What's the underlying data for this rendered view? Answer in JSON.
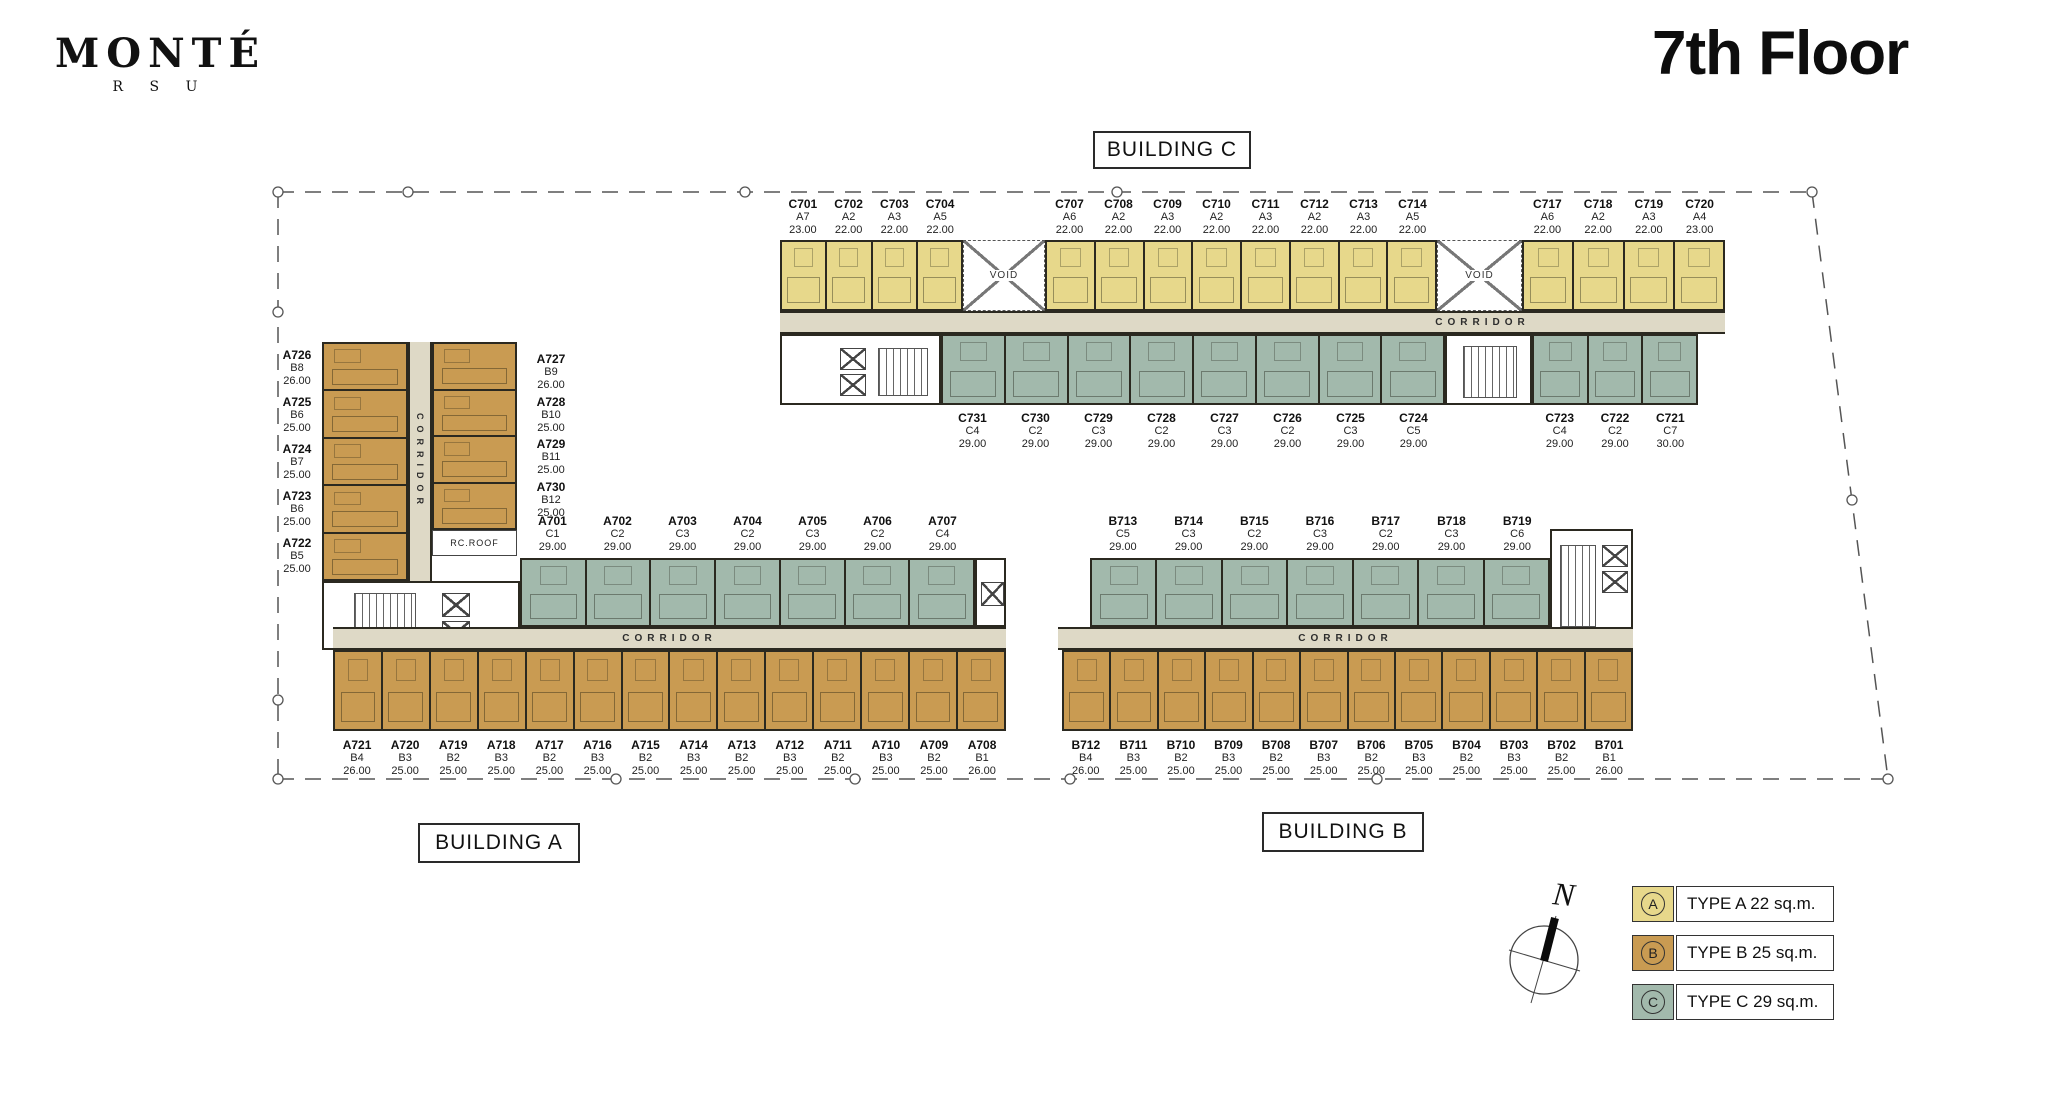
{
  "header": {
    "logo_title": "MONTÉ",
    "logo_subtitle": "R S U",
    "floor_title": "7th Floor"
  },
  "misc": {
    "void": "VOID",
    "corridor": "CORRIDOR",
    "rc_roof": "RC.ROOF",
    "north": "N"
  },
  "colors": {
    "type_a": "#e7d88b",
    "type_b": "#c99b52",
    "type_c": "#a2b9ac",
    "corridor": "#ded9c6",
    "outline": "#2b2920",
    "boundary": "#555555"
  },
  "legend": {
    "items": [
      {
        "key": "A",
        "label": "TYPE A 22 sq.m.",
        "color_key": "type_a"
      },
      {
        "key": "B",
        "label": "TYPE B 25 sq.m.",
        "color_key": "type_b"
      },
      {
        "key": "C",
        "label": "TYPE C 29 sq.m.",
        "color_key": "type_c"
      }
    ]
  },
  "buildings": {
    "c": {
      "label": "BUILDING C",
      "north_seg1": [
        {
          "id": "C701",
          "type": "A7",
          "area": "23.00"
        },
        {
          "id": "C702",
          "type": "A2",
          "area": "22.00"
        },
        {
          "id": "C703",
          "type": "A3",
          "area": "22.00"
        },
        {
          "id": "C704",
          "type": "A5",
          "area": "22.00"
        }
      ],
      "north_seg2": [
        {
          "id": "C707",
          "type": "A6",
          "area": "22.00"
        },
        {
          "id": "C708",
          "type": "A2",
          "area": "22.00"
        },
        {
          "id": "C709",
          "type": "A3",
          "area": "22.00"
        },
        {
          "id": "C710",
          "type": "A2",
          "area": "22.00"
        },
        {
          "id": "C711",
          "type": "A3",
          "area": "22.00"
        },
        {
          "id": "C712",
          "type": "A2",
          "area": "22.00"
        },
        {
          "id": "C713",
          "type": "A3",
          "area": "22.00"
        },
        {
          "id": "C714",
          "type": "A5",
          "area": "22.00"
        }
      ],
      "north_seg3": [
        {
          "id": "C717",
          "type": "A6",
          "area": "22.00"
        },
        {
          "id": "C718",
          "type": "A2",
          "area": "22.00"
        },
        {
          "id": "C719",
          "type": "A3",
          "area": "22.00"
        },
        {
          "id": "C720",
          "type": "A4",
          "area": "23.00"
        }
      ],
      "south_seg1": [
        {
          "id": "C731",
          "type": "C4",
          "area": "29.00"
        },
        {
          "id": "C730",
          "type": "C2",
          "area": "29.00"
        },
        {
          "id": "C729",
          "type": "C3",
          "area": "29.00"
        },
        {
          "id": "C728",
          "type": "C2",
          "area": "29.00"
        },
        {
          "id": "C727",
          "type": "C3",
          "area": "29.00"
        },
        {
          "id": "C726",
          "type": "C2",
          "area": "29.00"
        },
        {
          "id": "C725",
          "type": "C3",
          "area": "29.00"
        },
        {
          "id": "C724",
          "type": "C5",
          "area": "29.00"
        }
      ],
      "south_seg2": [
        {
          "id": "C723",
          "type": "C4",
          "area": "29.00"
        },
        {
          "id": "C722",
          "type": "C2",
          "area": "29.00"
        },
        {
          "id": "C721",
          "type": "C7",
          "area": "30.00"
        }
      ]
    },
    "a": {
      "label": "BUILDING A",
      "wing_west": [
        {
          "id": "A726",
          "type": "B8",
          "area": "26.00"
        },
        {
          "id": "A725",
          "type": "B6",
          "area": "25.00"
        },
        {
          "id": "A724",
          "type": "B7",
          "area": "25.00"
        },
        {
          "id": "A723",
          "type": "B6",
          "area": "25.00"
        },
        {
          "id": "A722",
          "type": "B5",
          "area": "25.00"
        }
      ],
      "wing_east": [
        {
          "id": "A727",
          "type": "B9",
          "area": "26.00"
        },
        {
          "id": "A728",
          "type": "B10",
          "area": "25.00"
        },
        {
          "id": "A729",
          "type": "B11",
          "area": "25.00"
        },
        {
          "id": "A730",
          "type": "B12",
          "area": "25.00"
        }
      ],
      "north": [
        {
          "id": "A701",
          "type": "C1",
          "area": "29.00"
        },
        {
          "id": "A702",
          "type": "C2",
          "area": "29.00"
        },
        {
          "id": "A703",
          "type": "C3",
          "area": "29.00"
        },
        {
          "id": "A704",
          "type": "C2",
          "area": "29.00"
        },
        {
          "id": "A705",
          "type": "C3",
          "area": "29.00"
        },
        {
          "id": "A706",
          "type": "C2",
          "area": "29.00"
        },
        {
          "id": "A707",
          "type": "C4",
          "area": "29.00"
        }
      ],
      "south": [
        {
          "id": "A721",
          "type": "B4",
          "area": "26.00"
        },
        {
          "id": "A720",
          "type": "B3",
          "area": "25.00"
        },
        {
          "id": "A719",
          "type": "B2",
          "area": "25.00"
        },
        {
          "id": "A718",
          "type": "B3",
          "area": "25.00"
        },
        {
          "id": "A717",
          "type": "B2",
          "area": "25.00"
        },
        {
          "id": "A716",
          "type": "B3",
          "area": "25.00"
        },
        {
          "id": "A715",
          "type": "B2",
          "area": "25.00"
        },
        {
          "id": "A714",
          "type": "B3",
          "area": "25.00"
        },
        {
          "id": "A713",
          "type": "B2",
          "area": "25.00"
        },
        {
          "id": "A712",
          "type": "B3",
          "area": "25.00"
        },
        {
          "id": "A711",
          "type": "B2",
          "area": "25.00"
        },
        {
          "id": "A710",
          "type": "B3",
          "area": "25.00"
        },
        {
          "id": "A709",
          "type": "B2",
          "area": "25.00"
        },
        {
          "id": "A708",
          "type": "B1",
          "area": "26.00"
        }
      ]
    },
    "b": {
      "label": "BUILDING B",
      "north": [
        {
          "id": "B713",
          "type": "C5",
          "area": "29.00"
        },
        {
          "id": "B714",
          "type": "C3",
          "area": "29.00"
        },
        {
          "id": "B715",
          "type": "C2",
          "area": "29.00"
        },
        {
          "id": "B716",
          "type": "C3",
          "area": "29.00"
        },
        {
          "id": "B717",
          "type": "C2",
          "area": "29.00"
        },
        {
          "id": "B718",
          "type": "C3",
          "area": "29.00"
        },
        {
          "id": "B719",
          "type": "C6",
          "area": "29.00"
        }
      ],
      "south": [
        {
          "id": "B712",
          "type": "B4",
          "area": "26.00"
        },
        {
          "id": "B711",
          "type": "B3",
          "area": "25.00"
        },
        {
          "id": "B710",
          "type": "B2",
          "area": "25.00"
        },
        {
          "id": "B709",
          "type": "B3",
          "area": "25.00"
        },
        {
          "id": "B708",
          "type": "B2",
          "area": "25.00"
        },
        {
          "id": "B707",
          "type": "B3",
          "area": "25.00"
        },
        {
          "id": "B706",
          "type": "B2",
          "area": "25.00"
        },
        {
          "id": "B705",
          "type": "B3",
          "area": "25.00"
        },
        {
          "id": "B704",
          "type": "B2",
          "area": "25.00"
        },
        {
          "id": "B703",
          "type": "B3",
          "area": "25.00"
        },
        {
          "id": "B702",
          "type": "B2",
          "area": "25.00"
        },
        {
          "id": "B701",
          "type": "B1",
          "area": "26.00"
        }
      ]
    }
  }
}
